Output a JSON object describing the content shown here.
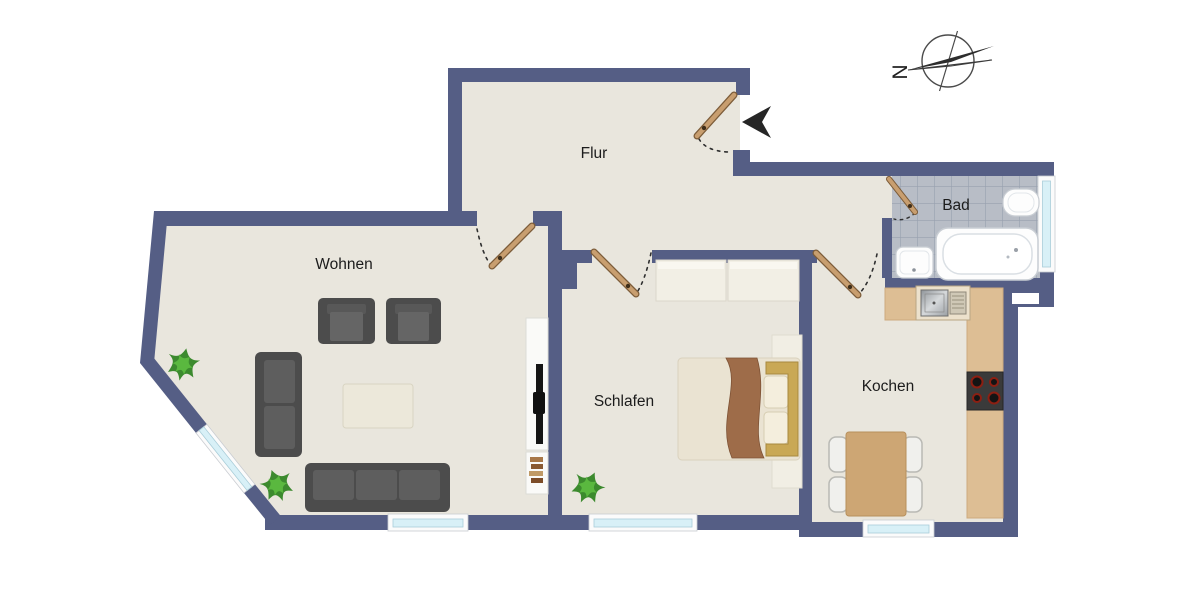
{
  "plan": {
    "type": "apartment-floor-plan",
    "language": "de"
  },
  "rooms": [
    {
      "id": "flur",
      "label": "Flur",
      "furniture": []
    },
    {
      "id": "wohnen",
      "label": "Wohnen",
      "furniture": [
        "sofa-3seat",
        "sofa-2seat",
        "armchair",
        "armchair",
        "coffee-table",
        "tv-board",
        "tv",
        "bookshelf",
        "plant",
        "plant"
      ]
    },
    {
      "id": "schlafen",
      "label": "Schlafen",
      "furniture": [
        "double-bed",
        "wardrobe",
        "side-panel",
        "plant"
      ]
    },
    {
      "id": "kochen",
      "label": "Kochen",
      "furniture": [
        "counter-top",
        "counter-right",
        "kitchen-sink",
        "stove",
        "dining-table",
        "chair",
        "chair",
        "chair",
        "chair"
      ]
    },
    {
      "id": "bad",
      "label": "Bad",
      "furniture": [
        "bathtub",
        "toilet",
        "washbasin"
      ]
    }
  ],
  "doors": [
    "entrance-door",
    "wohnen-door",
    "schlafen-door",
    "kochen-door",
    "bad-door"
  ],
  "windows": [
    "wohnen-diagonal-window",
    "wohnen-bottom-window",
    "schlafen-window",
    "kochen-window",
    "bad-window"
  ],
  "compass": {
    "label": "N"
  },
  "colors": {
    "wall": "#555e85",
    "floor": "#e9e6dd",
    "bath_tile": "#b8bdc6",
    "bath_tile_line": "#98a0ae",
    "window_glass": "#d8f0f7",
    "window_frame": "#fbfbfb",
    "door_leaf": "#c89e6f",
    "furniture_dark": "#4c4c4c",
    "furniture_cushion": "#5e5e5e",
    "wood_counter": "#ddbe94",
    "wood_table": "#cda674",
    "blanket_brown": "#9e6c49",
    "plant_green": "#3c8a2e",
    "entrance_arrow": "#262626"
  }
}
